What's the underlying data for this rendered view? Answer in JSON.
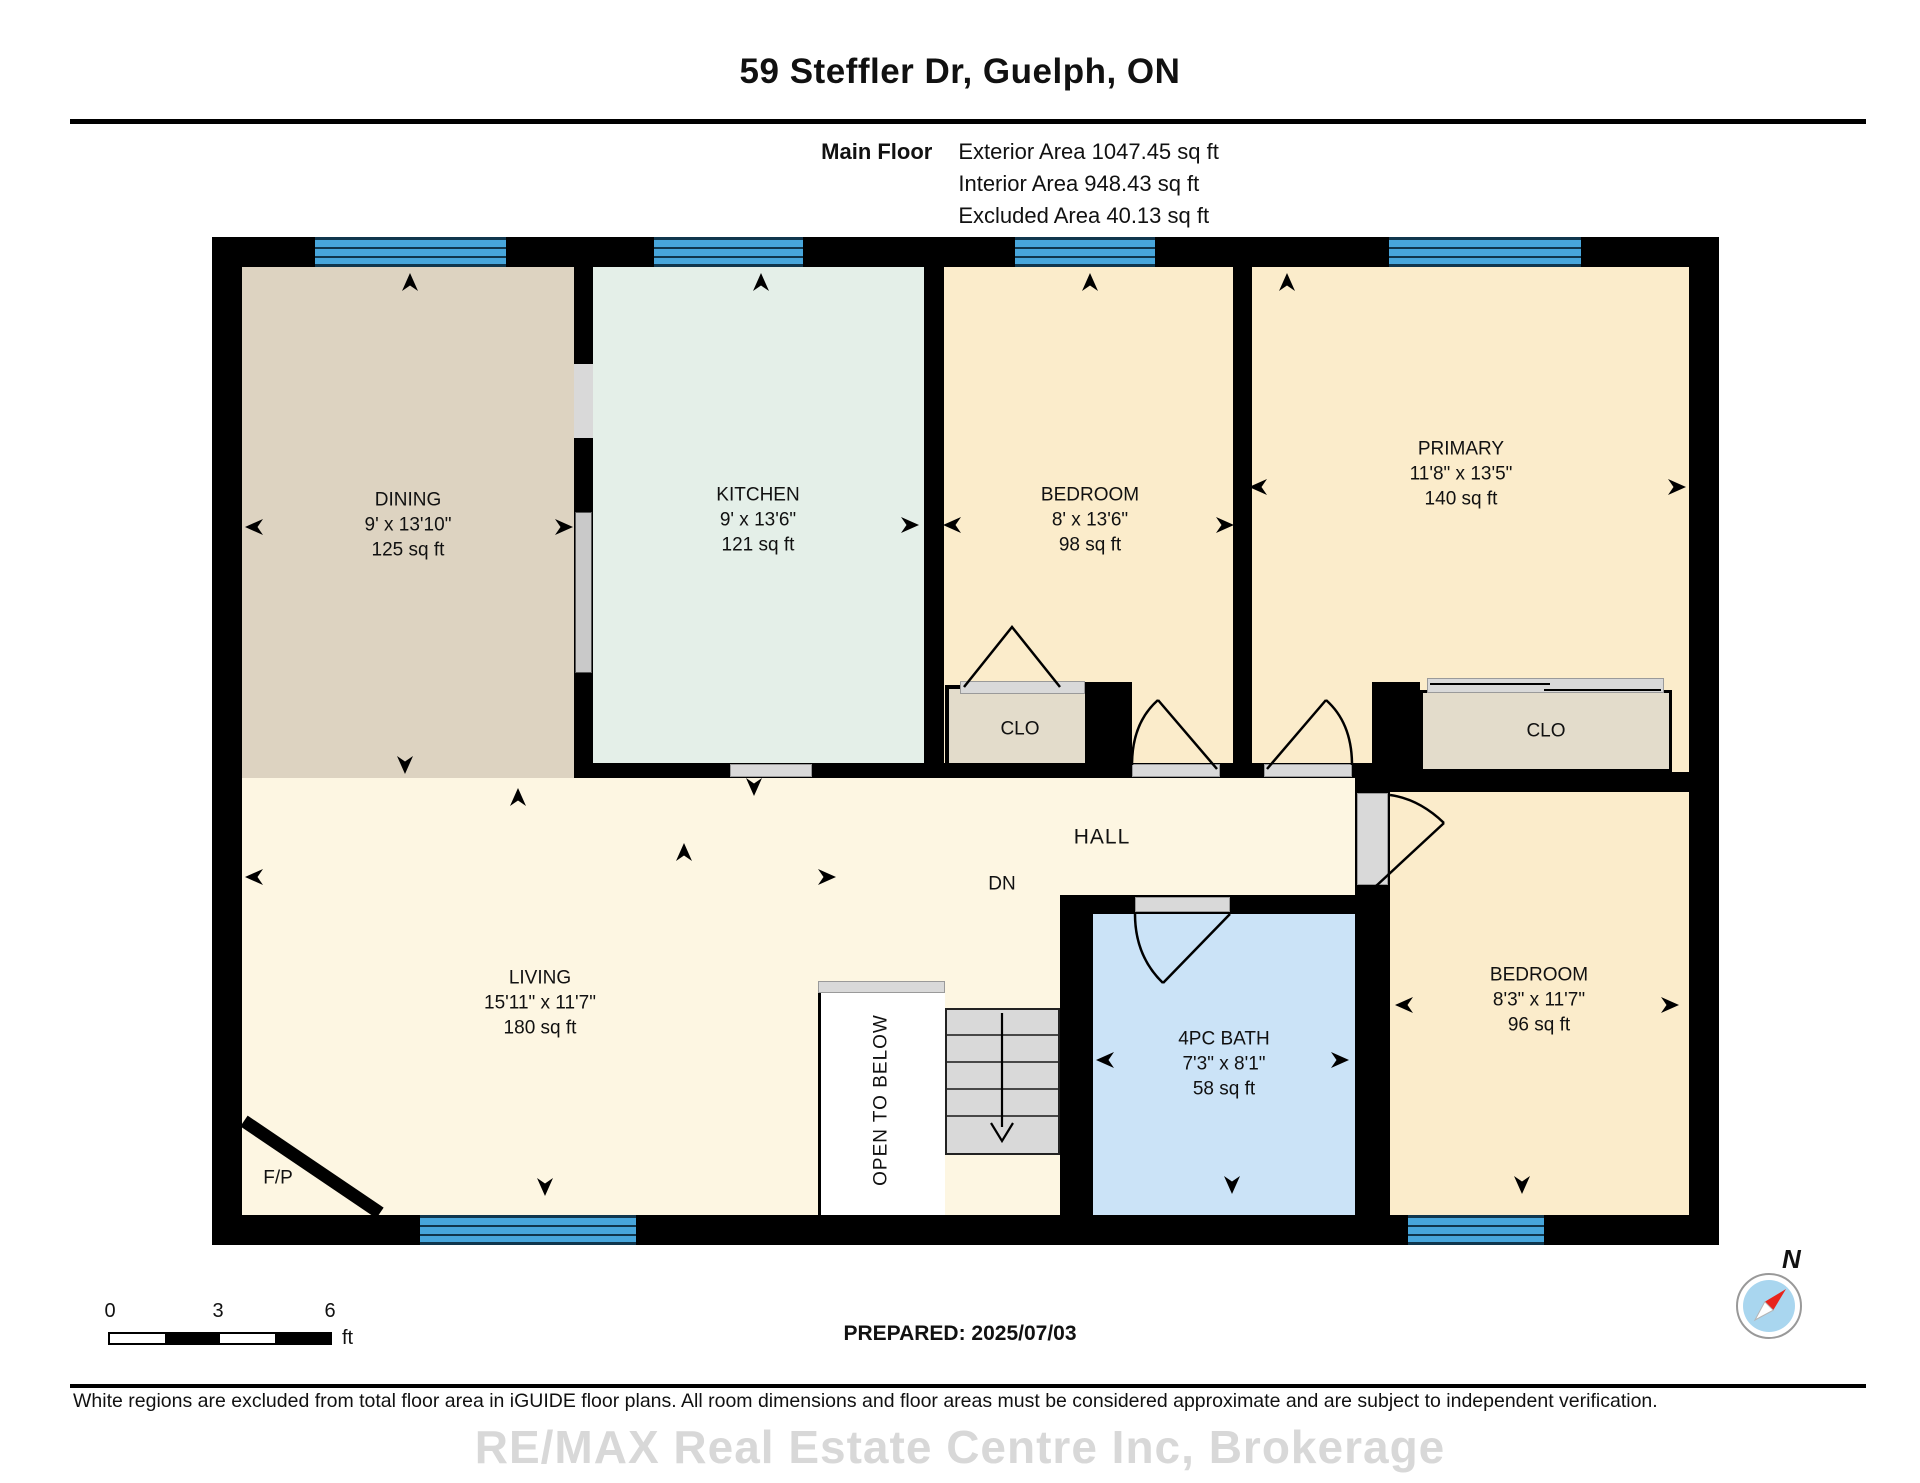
{
  "page": {
    "title": "59 Steffler Dr, Guelph, ON",
    "floor_label": "Main Floor",
    "areas": [
      "Exterior Area 1047.45 sq ft",
      "Interior Area 948.43 sq ft",
      "Excluded Area 40.13 sq ft"
    ],
    "prepared": "PREPARED: 2025/07/03",
    "disclaimer": "White regions are excluded from total floor area in iGUIDE floor plans. All room dimensions and floor areas must be considered approximate and are subject to independent verification.",
    "watermark": "RE/MAX Real Estate Centre Inc, Brokerage"
  },
  "rooms": {
    "dining": {
      "name": "DINING",
      "dims": "9' x 13'10\"",
      "area": "125 sq ft"
    },
    "kitchen": {
      "name": "KITCHEN",
      "dims": "9' x 13'6\"",
      "area": "121 sq ft"
    },
    "bedroom_top": {
      "name": "BEDROOM",
      "dims": "8' x 13'6\"",
      "area": "98 sq ft"
    },
    "primary": {
      "name": "PRIMARY",
      "dims": "11'8\" x 13'5\"",
      "area": "140 sq ft"
    },
    "living": {
      "name": "LIVING",
      "dims": "15'11\" x 11'7\"",
      "area": "180 sq ft"
    },
    "bath": {
      "name": "4PC BATH",
      "dims": "7'3\" x 8'1\"",
      "area": "58 sq ft"
    },
    "bedroom_br": {
      "name": "BEDROOM",
      "dims": "8'3\" x 11'7\"",
      "area": "96 sq ft"
    },
    "hall": {
      "name": "HALL"
    },
    "stairs_dn": {
      "name": "DN"
    },
    "closet_left": {
      "name": "CLO"
    },
    "closet_right": {
      "name": "CLO"
    },
    "open_below": {
      "name": "OPEN TO BELOW"
    },
    "fireplace": {
      "name": "F/P"
    }
  },
  "scale_bar": {
    "tick0": "0",
    "tick1": "3",
    "tick2": "6",
    "unit": "ft"
  },
  "compass": {
    "label": "N"
  },
  "colors": {
    "wall": "#000000",
    "window_blue": "#47a6dc",
    "window_line": "#10364d",
    "door_gray": "#d9d9d9",
    "dining": "#ddd3c1",
    "kitchen": "#e4efe8",
    "bedroom": "#fbeccb",
    "living": "#fdf6e2",
    "bath": "#cbe3f7",
    "closet": "#e3dccb",
    "watermark_gray": "#d8d8d8"
  }
}
